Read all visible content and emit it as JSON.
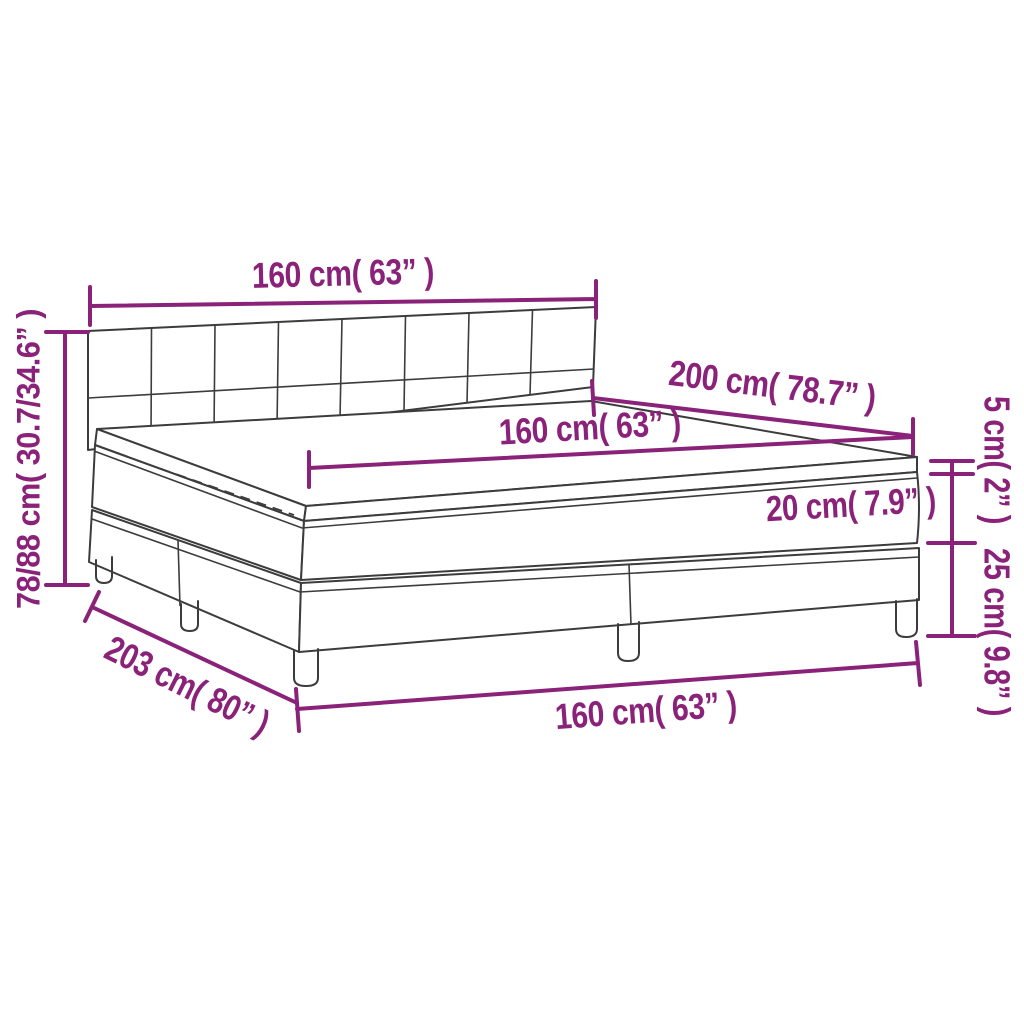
{
  "diagram": {
    "kind": "product-dimension-diagram",
    "subject": "box spring bed with headboard, mattress and topper",
    "colors": {
      "dimension": "#8A2279",
      "outline": "#3C3C3C",
      "background": "#FFFFFF"
    },
    "labels": {
      "headboard_width": "160 cm( 63” )",
      "bed_height": "78/88 cm( 30.7/34.6” )",
      "mattress_length": "200 cm( 78.7” )",
      "mattress_width": "160 cm( 63” )",
      "mattress_thickness": "20 cm( 7.9” )",
      "topper_thickness": "5 cm( 2” )",
      "base_height": "25 cm( 9.8” )",
      "total_length": "203 cm( 80” )",
      "base_width": "160 cm( 63” )"
    }
  }
}
